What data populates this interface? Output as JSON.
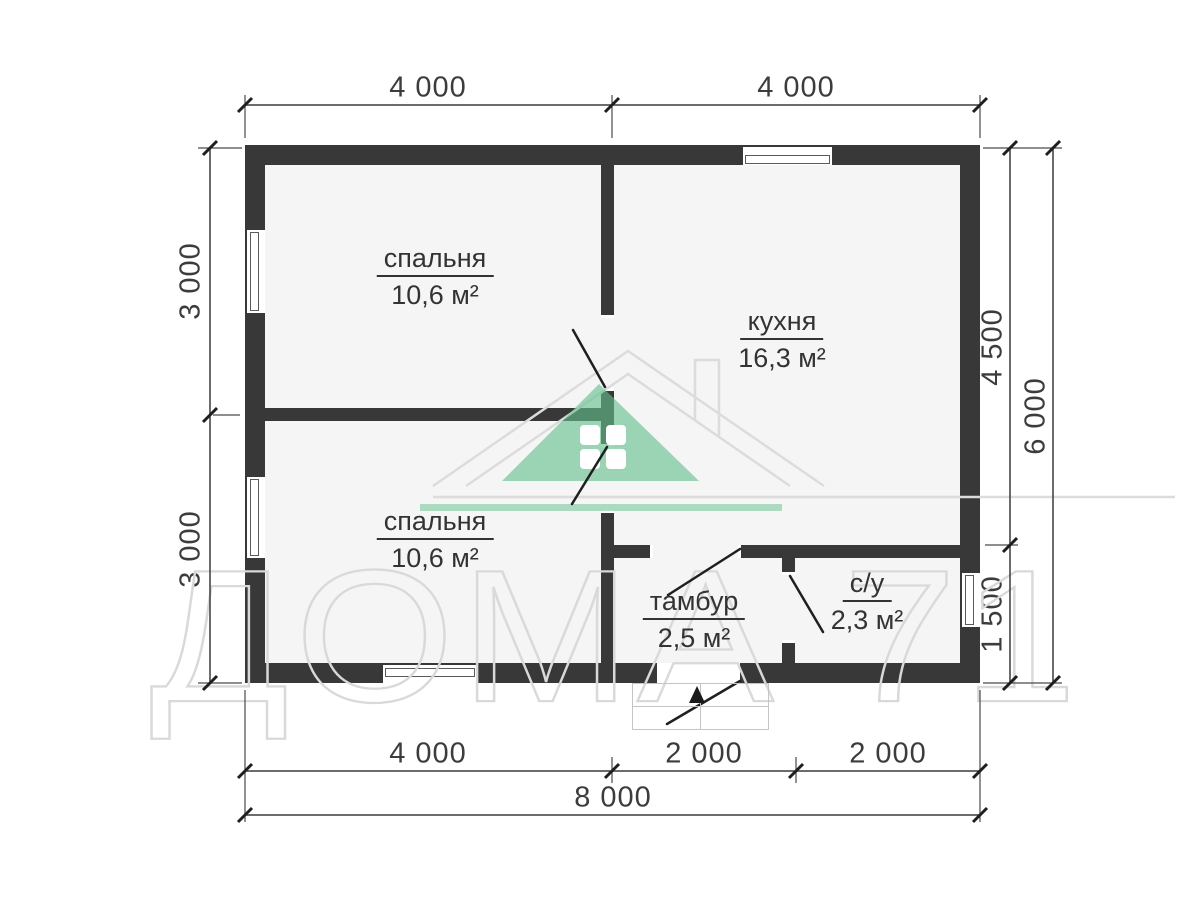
{
  "plan_title": "house floor plan 8000 x 6000",
  "rooms": {
    "bedroom1": {
      "name": "спальня",
      "area": "10,6 м²"
    },
    "kitchen": {
      "name": "кухня",
      "area": "16,3 м²"
    },
    "bedroom2": {
      "name": "спальня",
      "area": "10,6 м²"
    },
    "tambur": {
      "name": "тамбур",
      "area": "2,5 м²"
    },
    "su": {
      "name": "с/у",
      "area": "2,3 м²"
    }
  },
  "dimensions": {
    "top": [
      "4 000",
      "4 000"
    ],
    "left": [
      "3 000",
      "3 000"
    ],
    "right_inner": [
      "4 500",
      "1 500"
    ],
    "right_outer": "6 000",
    "bottom_segments": [
      "4 000",
      "2 000",
      "2 000"
    ],
    "bottom_total": "8 000"
  },
  "watermark": {
    "text": "ДОМА 71"
  },
  "colors": {
    "wall": "#383838",
    "dim": "#3c3c3c",
    "outline": "#d9d9d9"
  }
}
